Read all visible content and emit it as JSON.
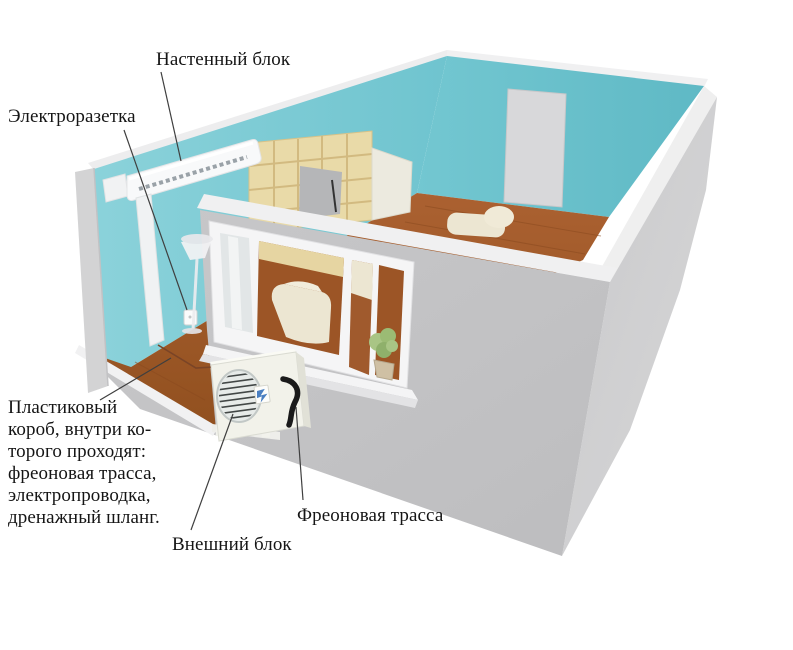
{
  "diagram": {
    "kind": "air-conditioner-installation-room-cutaway",
    "labels": {
      "wall_unit": {
        "text": "Настенный блок"
      },
      "outlet": {
        "text": "Электроразетка"
      },
      "plastic_duct": {
        "lines": [
          "Пластиковый",
          "короб, внутри ко-",
          "торого проходят:",
          "фреоновая трасса,",
          "электропроводка,",
          "дренажный шланг."
        ]
      },
      "outdoor_unit": {
        "text": "Внешний блок"
      },
      "freon_line": {
        "text": "Фреоновая трасса"
      }
    },
    "colors": {
      "wall_teal": "#79c9d2",
      "wall_teal_dark": "#68c0cb",
      "exterior_gray": "#c4c4c6",
      "exterior_gray_light": "#d0d0d2",
      "trim_white": "#f3f3f4",
      "floor_wood": "#a15a2b",
      "bookshelf_tan": "#e8d8a4",
      "sofa_cream": "#ece6d2",
      "door_gray": "#d7d7d9",
      "pipe_black": "#1a1a1a",
      "label_text": "#151515"
    }
  }
}
